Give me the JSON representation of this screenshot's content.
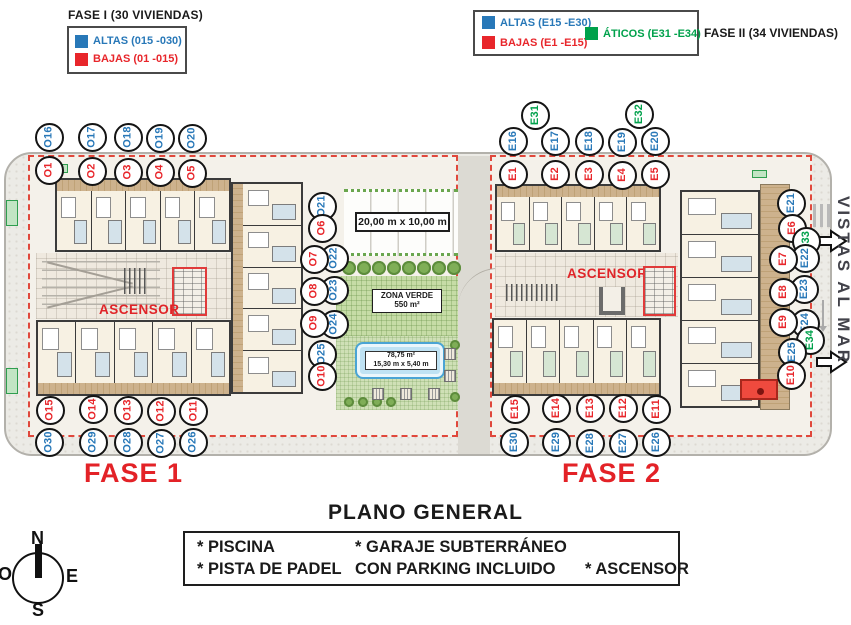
{
  "legend_fase1": {
    "title": "FASE I (30 VIVIENDAS)",
    "altas_label": "ALTAS (015 -030)",
    "bajas_label": "BAJAS (01 -015)"
  },
  "legend_fase2": {
    "title": "FASE II (34 VIVIENDAS)",
    "altas_label": "ALTAS (E15 -E30)",
    "bajas_label": "BAJAS (E1 -E15)",
    "aticos_label": "ÁTICOS (E31 -E34)"
  },
  "colors": {
    "altas": "#2878b8",
    "bajas": "#e8262b",
    "aticos": "#00a14b",
    "boundary": "#e0483c",
    "fase_text": "#e32227"
  },
  "plan": {
    "fase1_label": "FASE 1",
    "fase2_label": "FASE 2",
    "ascensor_fase1": "ASCENSOR",
    "ascensor_fase2": "ASCENSOR",
    "padel_dimensions": "20,00 m x 10,00 m",
    "zona_verde_label": "ZONA VERDE",
    "zona_verde_area": "550 m²",
    "pool_area": "78,75 m²",
    "pool_dimensions": "15,30 m x 5,40 m",
    "vistas_al_mar": "VISTAS AL MAR",
    "units": [
      {
        "label": "O16",
        "x": 49,
        "y": 137,
        "type": "altas"
      },
      {
        "label": "O17",
        "x": 92,
        "y": 137,
        "type": "altas"
      },
      {
        "label": "O18",
        "x": 128,
        "y": 137,
        "type": "altas"
      },
      {
        "label": "O19",
        "x": 160,
        "y": 138,
        "type": "altas"
      },
      {
        "label": "O20",
        "x": 192,
        "y": 138,
        "type": "altas"
      },
      {
        "label": "O1",
        "x": 49,
        "y": 170,
        "type": "bajas"
      },
      {
        "label": "O2",
        "x": 92,
        "y": 171,
        "type": "bajas"
      },
      {
        "label": "O3",
        "x": 128,
        "y": 172,
        "type": "bajas"
      },
      {
        "label": "O4",
        "x": 160,
        "y": 172,
        "type": "bajas"
      },
      {
        "label": "O5",
        "x": 192,
        "y": 173,
        "type": "bajas"
      },
      {
        "label": "O21",
        "x": 322,
        "y": 206,
        "type": "altas"
      },
      {
        "label": "O6",
        "x": 322,
        "y": 228,
        "type": "bajas"
      },
      {
        "label": "O22",
        "x": 334,
        "y": 258,
        "type": "altas"
      },
      {
        "label": "O7",
        "x": 314,
        "y": 259,
        "type": "bajas"
      },
      {
        "label": "O23",
        "x": 334,
        "y": 290,
        "type": "altas"
      },
      {
        "label": "O8",
        "x": 314,
        "y": 291,
        "type": "bajas"
      },
      {
        "label": "O24",
        "x": 334,
        "y": 324,
        "type": "altas"
      },
      {
        "label": "O9",
        "x": 314,
        "y": 323,
        "type": "bajas"
      },
      {
        "label": "O25",
        "x": 322,
        "y": 354,
        "type": "altas"
      },
      {
        "label": "O10",
        "x": 322,
        "y": 376,
        "type": "bajas"
      },
      {
        "label": "O15",
        "x": 50,
        "y": 410,
        "type": "bajas"
      },
      {
        "label": "O14",
        "x": 93,
        "y": 409,
        "type": "bajas"
      },
      {
        "label": "O13",
        "x": 128,
        "y": 410,
        "type": "bajas"
      },
      {
        "label": "O12",
        "x": 161,
        "y": 411,
        "type": "bajas"
      },
      {
        "label": "O11",
        "x": 193,
        "y": 411,
        "type": "bajas"
      },
      {
        "label": "O30",
        "x": 49,
        "y": 442,
        "type": "altas"
      },
      {
        "label": "O29",
        "x": 93,
        "y": 442,
        "type": "altas"
      },
      {
        "label": "O28",
        "x": 128,
        "y": 442,
        "type": "altas"
      },
      {
        "label": "O27",
        "x": 161,
        "y": 443,
        "type": "altas"
      },
      {
        "label": "O26",
        "x": 193,
        "y": 442,
        "type": "altas"
      },
      {
        "label": "E31",
        "x": 535,
        "y": 115,
        "type": "aticos"
      },
      {
        "label": "E32",
        "x": 639,
        "y": 114,
        "type": "aticos"
      },
      {
        "label": "E16",
        "x": 513,
        "y": 141,
        "type": "altas"
      },
      {
        "label": "E17",
        "x": 555,
        "y": 141,
        "type": "altas"
      },
      {
        "label": "E18",
        "x": 589,
        "y": 141,
        "type": "altas"
      },
      {
        "label": "E19",
        "x": 622,
        "y": 142,
        "type": "altas"
      },
      {
        "label": "E20",
        "x": 655,
        "y": 141,
        "type": "altas"
      },
      {
        "label": "E1",
        "x": 513,
        "y": 174,
        "type": "bajas"
      },
      {
        "label": "E2",
        "x": 555,
        "y": 174,
        "type": "bajas"
      },
      {
        "label": "E3",
        "x": 589,
        "y": 174,
        "type": "bajas"
      },
      {
        "label": "E4",
        "x": 622,
        "y": 175,
        "type": "bajas"
      },
      {
        "label": "E5",
        "x": 655,
        "y": 174,
        "type": "bajas"
      },
      {
        "label": "E21",
        "x": 791,
        "y": 203,
        "type": "altas"
      },
      {
        "label": "E6",
        "x": 792,
        "y": 228,
        "type": "bajas"
      },
      {
        "label": "E33",
        "x": 806,
        "y": 241,
        "type": "aticos"
      },
      {
        "label": "E22",
        "x": 805,
        "y": 258,
        "type": "altas"
      },
      {
        "label": "E7",
        "x": 783,
        "y": 259,
        "type": "bajas"
      },
      {
        "label": "E23",
        "x": 804,
        "y": 289,
        "type": "altas"
      },
      {
        "label": "E8",
        "x": 783,
        "y": 292,
        "type": "bajas"
      },
      {
        "label": "E24",
        "x": 805,
        "y": 323,
        "type": "altas"
      },
      {
        "label": "E9",
        "x": 783,
        "y": 322,
        "type": "bajas"
      },
      {
        "label": "E34",
        "x": 810,
        "y": 340,
        "type": "aticos"
      },
      {
        "label": "E25",
        "x": 792,
        "y": 352,
        "type": "altas"
      },
      {
        "label": "E10",
        "x": 791,
        "y": 375,
        "type": "bajas"
      },
      {
        "label": "E15",
        "x": 515,
        "y": 409,
        "type": "bajas"
      },
      {
        "label": "E14",
        "x": 556,
        "y": 408,
        "type": "bajas"
      },
      {
        "label": "E13",
        "x": 590,
        "y": 408,
        "type": "bajas"
      },
      {
        "label": "E12",
        "x": 623,
        "y": 408,
        "type": "bajas"
      },
      {
        "label": "E11",
        "x": 656,
        "y": 409,
        "type": "bajas"
      },
      {
        "label": "E30",
        "x": 514,
        "y": 442,
        "type": "altas"
      },
      {
        "label": "E29",
        "x": 556,
        "y": 442,
        "type": "altas"
      },
      {
        "label": "E28",
        "x": 590,
        "y": 443,
        "type": "altas"
      },
      {
        "label": "E27",
        "x": 623,
        "y": 443,
        "type": "altas"
      },
      {
        "label": "E26",
        "x": 656,
        "y": 442,
        "type": "altas"
      }
    ]
  },
  "footer": {
    "title": "PLANO GENERAL",
    "rows": [
      [
        "* PISCINA",
        "* GARAJE SUBTERRÁNEO",
        ""
      ],
      [
        "* PISTA DE PADEL",
        "CON PARKING INCLUIDO",
        "* ASCENSOR"
      ]
    ]
  },
  "compass": {
    "north": "N",
    "south": "S",
    "east": "E",
    "west": "O"
  }
}
